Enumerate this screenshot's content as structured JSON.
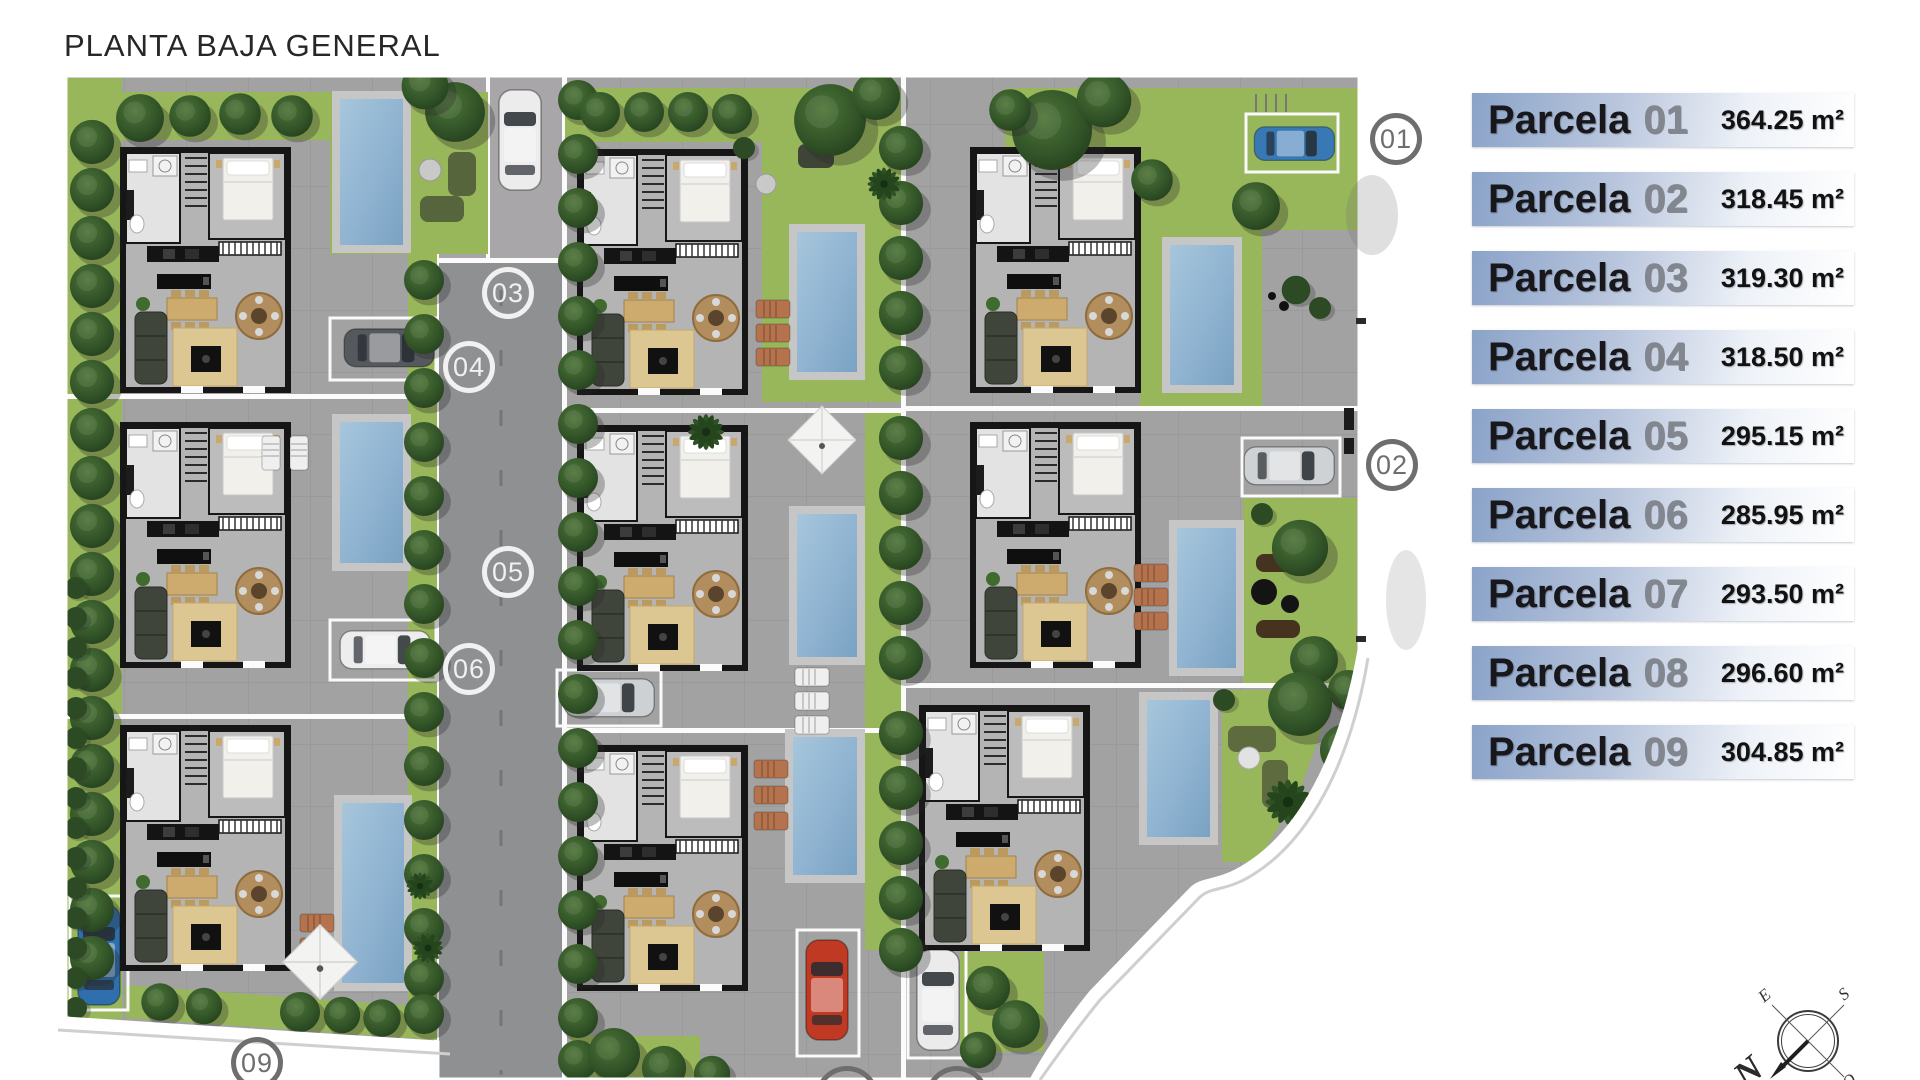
{
  "title": "PLANTA BAJA GENERAL",
  "legend": {
    "items": [
      {
        "label": "Parcela",
        "number": "01",
        "area": "364.25 m²"
      },
      {
        "label": "Parcela",
        "number": "02",
        "area": "318.45 m²"
      },
      {
        "label": "Parcela",
        "number": "03",
        "area": "319.30 m²"
      },
      {
        "label": "Parcela",
        "number": "04",
        "area": "318.50 m²"
      },
      {
        "label": "Parcela",
        "number": "05",
        "area": "295.15 m²"
      },
      {
        "label": "Parcela",
        "number": "06",
        "area": "285.95 m²"
      },
      {
        "label": "Parcela",
        "number": "07",
        "area": "293.50 m²"
      },
      {
        "label": "Parcela",
        "number": "08",
        "area": "296.60 m²"
      },
      {
        "label": "Parcela",
        "number": "09",
        "area": "304.85 m²"
      }
    ]
  },
  "markers": [
    {
      "label": "01"
    },
    {
      "label": "02"
    },
    {
      "label": "03"
    },
    {
      "label": "04"
    },
    {
      "label": "05"
    },
    {
      "label": "06"
    },
    {
      "label": "09"
    }
  ],
  "compass": {
    "north": "N",
    "south": "S",
    "east": "E",
    "west": "O"
  },
  "colors": {
    "pavement": "#a2a2a2",
    "road": "#8e9092",
    "grass": "#98b65a",
    "pool": "#8fb3d1",
    "legend_bar": "#8ba3c9",
    "legend_text": "#17171c",
    "legend_number": "#82878f",
    "marker_gray": "#6e6e6e",
    "marker_white": "#f1f1f1"
  }
}
